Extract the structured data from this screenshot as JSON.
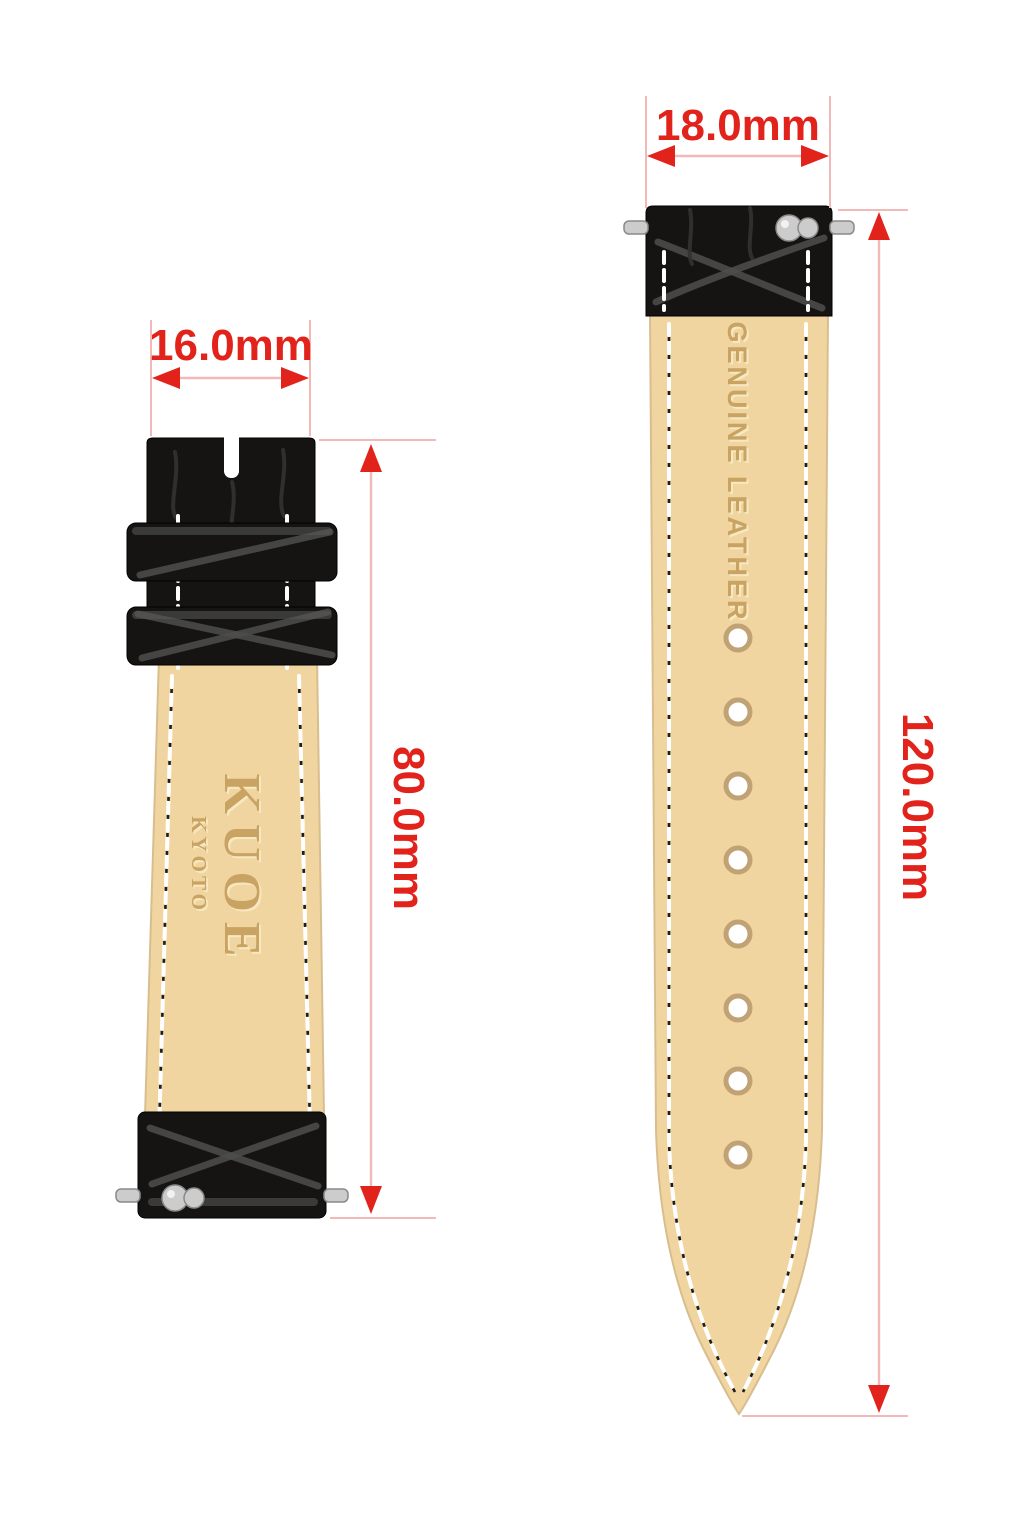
{
  "diagram": {
    "type": "watch-strap-dimension-diagram",
    "left_strap": {
      "width_label": "16.0mm",
      "length_label": "80.0mm",
      "brand": "KUOE",
      "brand_sub": "KYOTO",
      "description": "buckle-side strap, underside view, black croc leather with two keepers"
    },
    "right_strap": {
      "width_label": "18.0mm",
      "length_label": "120.0mm",
      "material_label": "GENUINE LEATHER",
      "holes_count": 8,
      "description": "tail-side strap, underside view, quick-release spring bar"
    }
  },
  "colors": {
    "red": "#e2231c",
    "pink": "#f2b9b9",
    "tan": "#f1d5a1",
    "tan_edge": "#d8be8e",
    "black": "#161412",
    "emboss": "#c8a362",
    "emboss_hi": "#f8e8c2",
    "stitch": "#ffffff",
    "hole_ring": "#c0a274"
  }
}
